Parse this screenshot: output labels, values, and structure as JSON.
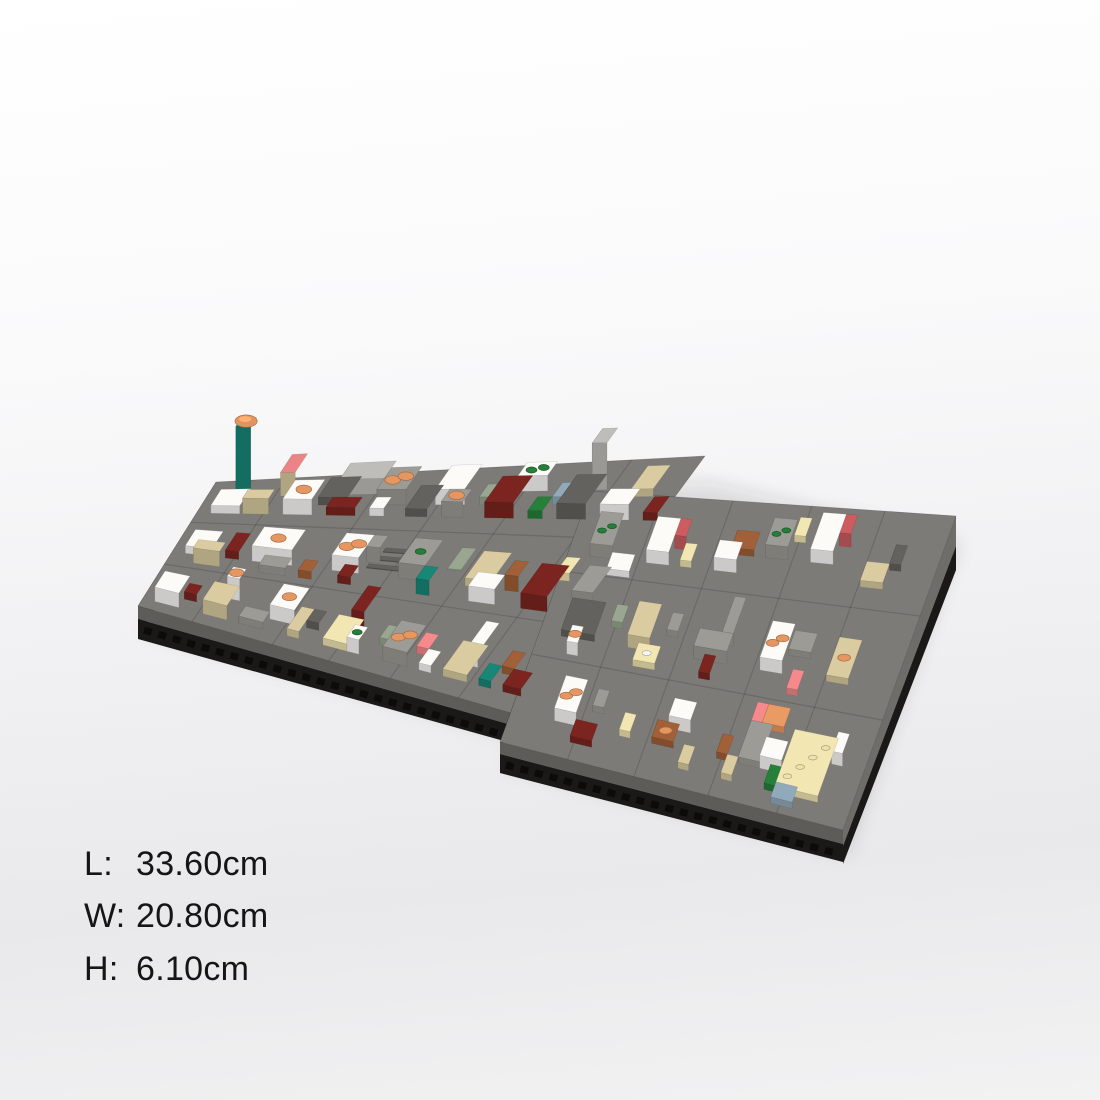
{
  "page": {
    "background_top": "#ffffff",
    "background_bottom": "#ebebed"
  },
  "dimensions": {
    "rows": [
      {
        "label": "L:",
        "value": "33.60cm"
      },
      {
        "label": "W:",
        "value": "20.80cm"
      },
      {
        "label": "H:",
        "value": "6.10cm"
      }
    ]
  },
  "scene": {
    "palette": {
      "white": "#f2f1ee",
      "tan": "#d2c49a",
      "cream": "#e9ddab",
      "lgray": "#b7b6b3",
      "mgray": "#96958f",
      "dgray": "#5f5e5b",
      "dred": "#77241f",
      "red": "#c5585c",
      "salmon": "#ec8487",
      "orange": "#e1945f",
      "teal": "#178273",
      "green": "#247c38",
      "sage": "#93a18b",
      "brown": "#9b5c36",
      "bgray": "#8ba3b4",
      "yellow": "#efe3a9"
    },
    "plate_colors": {
      "top": "#7c7b78",
      "seam": "rgba(0,0,0,0.14)",
      "lip_front": "#5d5c59",
      "lip_left": "#4a4946",
      "lip_right": "#6e6d6a",
      "lip_step": "#2b2a28",
      "black": "#1a1918",
      "holes": "#0b0b0b",
      "shadow": "rgba(45,45,52,0.12)"
    },
    "plates": {
      "A": {
        "w": 32,
        "d": 16,
        "c": [
          [
            138,
            606
          ],
          [
            515,
            714
          ],
          [
            705,
            456
          ],
          [
            216,
            482
          ]
        ]
      },
      "B": {
        "w": 32,
        "d": 16,
        "c": [
          [
            500,
            742
          ],
          [
            843,
            830
          ],
          [
            956,
            516
          ],
          [
            590,
            491
          ]
        ]
      }
    },
    "streets": {
      "A": {
        "xs": [
          4.6,
          11.4,
          16.2,
          21.4,
          27.2
        ],
        "ys": [
          5.4,
          10.8
        ]
      },
      "B": {
        "xs": [
          6.3,
          12.5,
          19.4,
          25.8
        ],
        "ys": [
          5.6,
          10.9
        ]
      }
    },
    "buildings": [
      {
        "p": "A",
        "x": 1,
        "y": 12,
        "w": 2,
        "d": 2,
        "h": 1,
        "c": "white"
      },
      {
        "p": "A",
        "x": 2,
        "y": 14,
        "w": 1,
        "d": 1,
        "h": 9,
        "c": "teal",
        "dome": "orange"
      },
      {
        "p": "A",
        "x": 3.2,
        "y": 12,
        "w": 1.8,
        "d": 1,
        "h": 2,
        "c": "tan"
      },
      {
        "p": "A",
        "x": 5,
        "y": 14,
        "w": 1,
        "d": 2,
        "h": 3,
        "c": "tan",
        "roof": "salmon"
      },
      {
        "p": "A",
        "x": 6,
        "y": 12,
        "w": 2,
        "d": 2,
        "h": 2,
        "c": "white",
        "st": {
          "c": "orange",
          "n": 1
        }
      },
      {
        "p": "A",
        "x": 8,
        "y": 13,
        "w": 2,
        "d": 2,
        "h": 1,
        "c": "dgray"
      },
      {
        "p": "A",
        "x": 9,
        "y": 14,
        "w": 3,
        "d": 1.6,
        "h": 2,
        "c": "lgray"
      },
      {
        "p": "A",
        "x": 9,
        "y": 12,
        "w": 2,
        "d": 1,
        "h": 1,
        "c": "dred"
      },
      {
        "p": "A",
        "x": 12,
        "y": 13,
        "w": 2,
        "d": 2,
        "h": 2,
        "c": "mgray",
        "st": {
          "c": "orange",
          "n": 2
        }
      },
      {
        "p": "A",
        "x": 12,
        "y": 12,
        "w": 1,
        "d": 1,
        "h": 1,
        "c": "white"
      },
      {
        "p": "A",
        "x": 14.5,
        "y": 12,
        "w": 1.5,
        "d": 2,
        "h": 1,
        "c": "dgray"
      },
      {
        "p": "A",
        "x": 16,
        "y": 13,
        "w": 2,
        "d": 2,
        "h": 2,
        "c": "white"
      },
      {
        "p": "A",
        "x": 17,
        "y": 12,
        "w": 1.5,
        "d": 1,
        "h": 2,
        "c": "mgray",
        "st": {
          "c": "orange",
          "n": 1
        }
      },
      {
        "p": "A",
        "x": 19,
        "y": 13,
        "w": 1,
        "d": 1,
        "h": 1,
        "c": "sage"
      },
      {
        "p": "A",
        "x": 20,
        "y": 12,
        "w": 2,
        "d": 2,
        "h": 2,
        "c": "dred"
      },
      {
        "p": "A",
        "x": 21,
        "y": 14,
        "w": 2,
        "d": 1,
        "h": 2,
        "c": "white",
        "st": {
          "c": "green",
          "n": 2
        }
      },
      {
        "p": "A",
        "x": 23,
        "y": 12,
        "w": 1,
        "d": 1,
        "h": 1,
        "c": "green"
      },
      {
        "p": "A",
        "x": 24,
        "y": 13,
        "w": 1,
        "d": 1,
        "h": 1,
        "c": "bgray"
      },
      {
        "p": "A",
        "x": 25,
        "y": 12,
        "w": 2,
        "d": 2,
        "h": 2,
        "c": "dgray"
      },
      {
        "p": "A",
        "x": 26,
        "y": 14,
        "w": 1,
        "d": 1,
        "h": 6,
        "c": "lgray"
      },
      {
        "p": "A",
        "x": 28,
        "y": 12,
        "w": 2,
        "d": 1,
        "h": 2,
        "c": "white"
      },
      {
        "p": "A",
        "x": 29,
        "y": 13.5,
        "w": 1.5,
        "d": 1.5,
        "h": 1,
        "c": "tan"
      },
      {
        "p": "A",
        "x": 31,
        "y": 12,
        "w": 1,
        "d": 1,
        "h": 1,
        "c": "dred"
      },
      {
        "p": "A",
        "x": 1,
        "y": 7,
        "w": 2,
        "d": 2,
        "h": 1,
        "c": "white"
      },
      {
        "p": "A",
        "x": 2,
        "y": 6,
        "w": 2,
        "d": 1,
        "h": 2,
        "c": "tan"
      },
      {
        "p": "A",
        "x": 4,
        "y": 7,
        "w": 1,
        "d": 2,
        "h": 1,
        "c": "dred"
      },
      {
        "p": "A",
        "x": 6,
        "y": 7,
        "w": 3,
        "d": 2,
        "h": 2,
        "c": "white",
        "st": {
          "c": "orange",
          "n": 1
        }
      },
      {
        "p": "A",
        "x": 7,
        "y": 6,
        "w": 2,
        "d": 1,
        "h": 1,
        "c": "mgray"
      },
      {
        "p": "A",
        "x": 10,
        "y": 6,
        "w": 1,
        "d": 1,
        "h": 1,
        "c": "brown"
      },
      {
        "p": "A",
        "x": 12,
        "y": 7,
        "w": 2,
        "d": 2,
        "h": 2,
        "c": "white",
        "st": {
          "c": "orange",
          "n": 2
        }
      },
      {
        "p": "A",
        "x": 13,
        "y": 6,
        "w": 1,
        "d": 1,
        "h": 1,
        "c": "dred"
      },
      {
        "p": "A",
        "x": 14,
        "y": 8,
        "w": 1,
        "d": 1,
        "h": 2,
        "c": "mgray"
      },
      {
        "p": "A",
        "x": 14.3,
        "y": 7.5,
        "w": 2.4,
        "d": 0.32,
        "h": 0.1,
        "c": "dgray"
      },
      {
        "p": "A",
        "x": 14.5,
        "y": 8.2,
        "w": 2.4,
        "d": 0.32,
        "h": 0.1,
        "c": "dgray"
      },
      {
        "p": "A",
        "x": 14.7,
        "y": 8.9,
        "w": 2.4,
        "d": 0.32,
        "h": 0.1,
        "c": "dgray"
      },
      {
        "p": "A",
        "x": 17,
        "y": 7,
        "w": 2,
        "d": 2,
        "h": 2,
        "c": "mgray",
        "st": {
          "c": "green",
          "n": 1
        }
      },
      {
        "p": "A",
        "x": 19,
        "y": 6,
        "w": 1,
        "d": 1,
        "h": 2,
        "c": "teal"
      },
      {
        "p": "A",
        "x": 20,
        "y": 8,
        "w": 1,
        "d": 1.6,
        "h": 0.15,
        "c": "sage"
      },
      {
        "p": "A",
        "x": 22,
        "y": 7,
        "w": 2,
        "d": 2,
        "h": 1,
        "c": "tan"
      },
      {
        "p": "A",
        "x": 23,
        "y": 6,
        "w": 2,
        "d": 1,
        "h": 2,
        "c": "white"
      },
      {
        "p": "A",
        "x": 25,
        "y": 7,
        "w": 1,
        "d": 1,
        "h": 2,
        "c": "brown"
      },
      {
        "p": "A",
        "x": 27,
        "y": 6,
        "w": 2,
        "d": 2,
        "h": 2,
        "c": "dred"
      },
      {
        "p": "A",
        "x": 28,
        "y": 8,
        "w": 1,
        "d": 1,
        "h": 1,
        "c": "cream"
      },
      {
        "p": "A",
        "x": 30,
        "y": 7,
        "w": 1.6,
        "d": 1.6,
        "h": 1,
        "c": "mgray"
      },
      {
        "p": "A",
        "x": 1,
        "y": 1,
        "w": 2,
        "d": 2,
        "h": 2,
        "c": "white"
      },
      {
        "p": "A",
        "x": 3,
        "y": 2,
        "w": 1,
        "d": 1,
        "h": 1,
        "c": "dred"
      },
      {
        "p": "A",
        "x": 5,
        "y": 1,
        "w": 2,
        "d": 2,
        "h": 2,
        "c": "tan"
      },
      {
        "p": "A",
        "x": 6,
        "y": 3,
        "w": 1,
        "d": 1,
        "h": 3,
        "c": "white",
        "st": {
          "c": "orange",
          "n": 1
        }
      },
      {
        "p": "A",
        "x": 8,
        "y": 1,
        "w": 2,
        "d": 1,
        "h": 1,
        "c": "mgray"
      },
      {
        "p": "A",
        "x": 10,
        "y": 2,
        "w": 2,
        "d": 2,
        "h": 2,
        "c": "white",
        "st": {
          "c": "orange",
          "n": 1
        }
      },
      {
        "p": "A",
        "x": 12,
        "y": 1,
        "w": 1,
        "d": 2,
        "h": 1,
        "c": "tan"
      },
      {
        "p": "A",
        "x": 13,
        "y": 2,
        "w": 1,
        "d": 1,
        "h": 1,
        "c": "dgray"
      },
      {
        "p": "A",
        "x": 15,
        "y": 1,
        "w": 2,
        "d": 2,
        "h": 1,
        "c": "cream"
      },
      {
        "p": "A",
        "x": 16,
        "y": 3,
        "w": 1,
        "d": 2,
        "h": 2,
        "c": "dred"
      },
      {
        "p": "A",
        "x": 17,
        "y": 1,
        "w": 1,
        "d": 1,
        "h": 2,
        "c": "white",
        "st": {
          "c": "green",
          "n": 1
        }
      },
      {
        "p": "A",
        "x": 19,
        "y": 2,
        "w": 1,
        "d": 1,
        "h": 1,
        "c": "sage"
      },
      {
        "p": "A",
        "x": 20,
        "y": 1,
        "w": 2,
        "d": 2,
        "h": 2,
        "c": "mgray",
        "st": {
          "c": "orange",
          "n": 2
        }
      },
      {
        "p": "A",
        "x": 22,
        "y": 2,
        "w": 1,
        "d": 1,
        "h": 1,
        "c": "salmon"
      },
      {
        "p": "A",
        "x": 23,
        "y": 1,
        "w": 1,
        "d": 1,
        "h": 1,
        "c": "white"
      },
      {
        "p": "A",
        "x": 25,
        "y": 1,
        "w": 2,
        "d": 2,
        "h": 1,
        "c": "tan"
      },
      {
        "p": "A",
        "x": 26,
        "y": 2,
        "w": 1,
        "d": 2,
        "h": 2,
        "c": "white"
      },
      {
        "p": "A",
        "x": 28,
        "y": 1,
        "w": 1,
        "d": 1,
        "h": 1,
        "c": "teal"
      },
      {
        "p": "A",
        "x": 29,
        "y": 2,
        "w": 1,
        "d": 1,
        "h": 1,
        "c": "brown"
      },
      {
        "p": "A",
        "x": 30,
        "y": 1,
        "w": 1.5,
        "d": 1,
        "h": 1,
        "c": "dred"
      },
      {
        "p": "B",
        "x": 2,
        "y": 12,
        "w": 2,
        "d": 2,
        "h": 2,
        "c": "mgray",
        "st": {
          "c": "green",
          "n": 2
        }
      },
      {
        "p": "B",
        "x": 4,
        "y": 11,
        "w": 2,
        "d": 1,
        "h": 1,
        "c": "white"
      },
      {
        "p": "B",
        "x": 7,
        "y": 12,
        "w": 2,
        "d": 2,
        "h": 2,
        "c": "white"
      },
      {
        "p": "B",
        "x": 9,
        "y": 13,
        "w": 1,
        "d": 1,
        "h": 2,
        "c": "red"
      },
      {
        "p": "B",
        "x": 10,
        "y": 12,
        "w": 1,
        "d": 1,
        "h": 1,
        "c": "cream"
      },
      {
        "p": "B",
        "x": 13,
        "y": 12,
        "w": 2,
        "d": 1,
        "h": 2,
        "c": "white"
      },
      {
        "p": "B",
        "x": 14,
        "y": 13,
        "w": 2,
        "d": 1,
        "h": 1,
        "c": "brown"
      },
      {
        "p": "B",
        "x": 17,
        "y": 13,
        "w": 2,
        "d": 1.5,
        "h": 2,
        "c": "mgray",
        "st": {
          "c": "green",
          "n": 2
        }
      },
      {
        "p": "B",
        "x": 19,
        "y": 14,
        "w": 1,
        "d": 1,
        "h": 1,
        "c": "cream"
      },
      {
        "p": "B",
        "x": 21,
        "y": 13,
        "w": 2,
        "d": 2,
        "h": 2,
        "c": "white"
      },
      {
        "p": "B",
        "x": 23,
        "y": 14,
        "w": 1,
        "d": 1,
        "h": 2,
        "c": "red"
      },
      {
        "p": "B",
        "x": 26,
        "y": 12,
        "w": 2,
        "d": 1,
        "h": 1,
        "c": "tan"
      },
      {
        "p": "B",
        "x": 28,
        "y": 13,
        "w": 1,
        "d": 1,
        "h": 1,
        "c": "dgray"
      },
      {
        "p": "B",
        "x": 2,
        "y": 7,
        "w": 3,
        "d": 2,
        "h": 1,
        "c": "dgray"
      },
      {
        "p": "B",
        "x": 3,
        "y": 6,
        "w": 1,
        "d": 1,
        "h": 2,
        "c": "white",
        "st": {
          "c": "orange",
          "n": 1
        }
      },
      {
        "p": "B",
        "x": 6,
        "y": 8,
        "w": 1,
        "d": 1,
        "h": 1,
        "c": "sage"
      },
      {
        "p": "B",
        "x": 8,
        "y": 7,
        "w": 2,
        "d": 2,
        "h": 2,
        "c": "tan"
      },
      {
        "p": "B",
        "x": 9,
        "y": 6,
        "w": 2,
        "d": 1,
        "h": 1,
        "c": "cream",
        "st": {
          "c": "white",
          "n": 1
        }
      },
      {
        "p": "B",
        "x": 11,
        "y": 8,
        "w": 1,
        "d": 1,
        "h": 1,
        "c": "mgray"
      },
      {
        "p": "B",
        "x": 14,
        "y": 7,
        "w": 3,
        "d": 1,
        "h": 2,
        "c": "mgray"
      },
      {
        "p": "B",
        "x": 16,
        "y": 8,
        "w": 1,
        "d": 2,
        "h": 2,
        "c": "mgray"
      },
      {
        "p": "B",
        "x": 15,
        "y": 6,
        "w": 1,
        "d": 1,
        "h": 1,
        "c": "dred"
      },
      {
        "p": "B",
        "x": 20,
        "y": 7,
        "w": 2,
        "d": 2,
        "h": 2,
        "c": "white",
        "st": {
          "c": "orange",
          "n": 2
        }
      },
      {
        "p": "B",
        "x": 22,
        "y": 8,
        "w": 2,
        "d": 1,
        "h": 1,
        "c": "mgray"
      },
      {
        "p": "B",
        "x": 23,
        "y": 6,
        "w": 1,
        "d": 1,
        "h": 1,
        "c": "salmon"
      },
      {
        "p": "B",
        "x": 26,
        "y": 7,
        "w": 2,
        "d": 2,
        "h": 1,
        "c": "tan",
        "st": {
          "c": "orange",
          "n": 1
        }
      },
      {
        "p": "B",
        "x": 4,
        "y": 2,
        "w": 2,
        "d": 2,
        "h": 2,
        "c": "white",
        "st": {
          "c": "orange",
          "n": 2
        }
      },
      {
        "p": "B",
        "x": 6,
        "y": 1,
        "w": 2,
        "d": 1,
        "h": 1,
        "c": "dred"
      },
      {
        "p": "B",
        "x": 7,
        "y": 3,
        "w": 1,
        "d": 1,
        "h": 1,
        "c": "mgray"
      },
      {
        "p": "B",
        "x": 10,
        "y": 2,
        "w": 1,
        "d": 1,
        "h": 1,
        "c": "cream"
      },
      {
        "p": "B",
        "x": 13,
        "y": 2,
        "w": 2,
        "d": 1,
        "h": 1,
        "c": "brown",
        "st": {
          "c": "orange",
          "n": 1
        }
      },
      {
        "p": "B",
        "x": 14,
        "y": 3,
        "w": 2,
        "d": 1,
        "h": 2,
        "c": "white"
      },
      {
        "p": "B",
        "x": 16,
        "y": 1,
        "w": 1,
        "d": 1,
        "h": 1,
        "c": "tan"
      },
      {
        "p": "B",
        "x": 19,
        "y": 2,
        "w": 1,
        "d": 1,
        "h": 1,
        "c": "brown"
      },
      {
        "p": "B",
        "x": 20,
        "y": 1,
        "w": 1,
        "d": 1,
        "h": 1,
        "c": "tan"
      },
      {
        "p": "B",
        "x": 21,
        "y": 2,
        "w": 2,
        "d": 2,
        "h": 1,
        "c": "mgray"
      },
      {
        "p": "B",
        "x": 21,
        "y": 4,
        "w": 1,
        "d": 1,
        "h": 1,
        "c": "salmon"
      },
      {
        "p": "B",
        "x": 22,
        "y": 4,
        "w": 2,
        "d": 1,
        "h": 1,
        "c": "orange"
      },
      {
        "p": "B",
        "x": 23,
        "y": 2,
        "w": 2,
        "d": 1,
        "h": 2,
        "c": "white"
      },
      {
        "p": "B",
        "x": 24,
        "y": 1,
        "w": 1,
        "d": 1,
        "h": 1,
        "c": "green"
      },
      {
        "p": "B",
        "x": 25,
        "y": 1,
        "w": 4,
        "d": 3,
        "h": 1,
        "c": "cream",
        "st": {
          "c": "cream",
          "n": 4
        }
      },
      {
        "p": "B",
        "x": 25,
        "y": 0.4,
        "w": 2,
        "d": 0.8,
        "h": 1,
        "c": "bgray"
      },
      {
        "p": "B",
        "x": 29,
        "y": 3,
        "w": 1,
        "d": 1,
        "h": 2,
        "c": "white"
      }
    ]
  }
}
